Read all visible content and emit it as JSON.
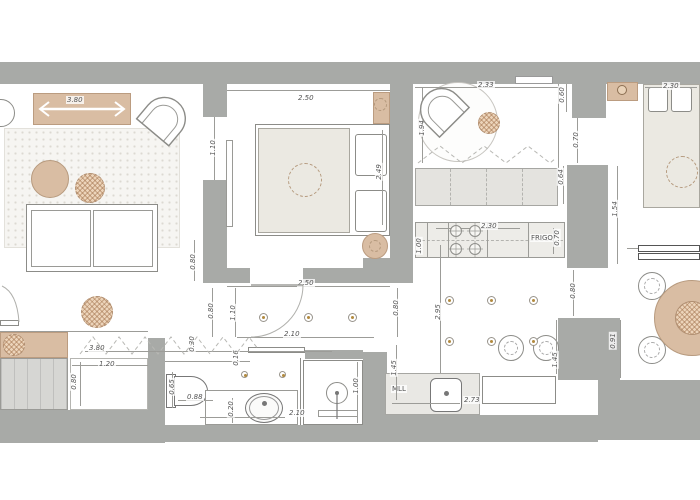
{
  "title": "apartment-floor-plan",
  "colors": {
    "wall": "#a8aaa7",
    "wood_accent": "#d9bda3",
    "furniture_beige": "#ebe9e2",
    "light_dot_gold": "#b28a3e"
  },
  "labels": {
    "frigo": "FRIGO",
    "mll": "MLL"
  },
  "dims": {
    "console_len": "3.80",
    "bed1_top": "2.50",
    "bed1_right": "2.49",
    "bed1_bottom": "2.50",
    "liv_bed_opening": "1.10",
    "sofa_gap": "0.80",
    "dressing_width": "3.80",
    "dressing_depth": "0.30",
    "closet_w": "1.20",
    "closet_d": "0.80",
    "hall_left": "0.80",
    "hall_door": "1.10",
    "hall_len": "2.10",
    "hall_right": "0.80",
    "bath_wall": "0.16",
    "wc_w": "0.65",
    "wc_d": "0.88",
    "bath_step": "0.20",
    "bath_len": "2.10",
    "shower_w": "1.00",
    "dining_top": "2.33",
    "dining_niche": "0.60",
    "dining_left": "1.94",
    "passage": "0.70",
    "wardrobe_d": "0.64",
    "counter_len": "2.30",
    "counter_left": "1.00",
    "counter_right": "0.70",
    "kitchen_len": "2.95",
    "kitchen_pass": "0.80",
    "island_gap": "1.45",
    "kitchen_width": "2.73",
    "kitchen_left_gap": "1.45",
    "bed2_top": "2.30",
    "bed2_left": "1.54",
    "table_gap": "0.91"
  }
}
